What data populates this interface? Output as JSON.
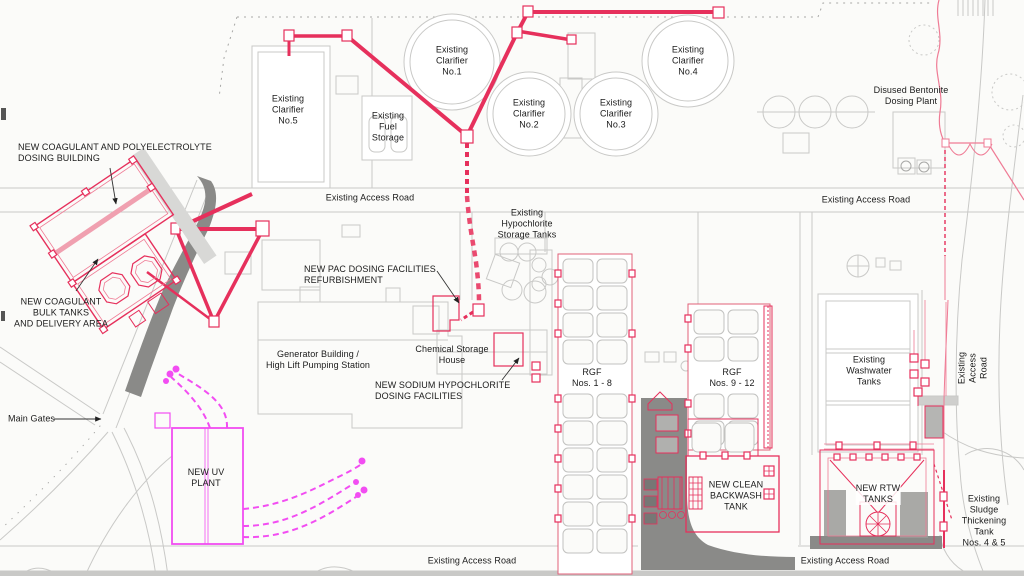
{
  "colors": {
    "bg": "#fbfbf9",
    "line": "#c9c9c7",
    "line-dark": "#a8a8a6",
    "pipe-red": "#e6305c",
    "pipe-dash": "#ea4a6f",
    "pink": "#ef7b95",
    "magenta": "#f24df2",
    "fill-dark": "#8a8a88",
    "fill-mid": "#9a9a98",
    "band": "#c9c9c7",
    "cell": "#c2c2c0",
    "rgf-edge": "#e06078",
    "text": "#1b1b1b"
  },
  "labels": {
    "new_coagulant_building": "NEW COAGULANT AND POLYELECTROLYTE\nDOSING BUILDING",
    "new_coagulant_tanks": "NEW COAGULANT\nBULK TANKS\nAND DELIVERY AREA",
    "main_gates": "Main Gates",
    "new_uv_plant": "NEW UV\nPLANT",
    "clarifier5": "Existing\nClarifier\nNo.5",
    "fuel_storage": "Existing\nFuel\nStorage",
    "clarifier1": "Existing\nClarifier\nNo.1",
    "clarifier2": "Existing\nClarifier\nNo.2",
    "clarifier3": "Existing\nClarifier\nNo.3",
    "clarifier4": "Existing\nClarifier\nNo.4",
    "disused_bentonite": "Disused Bentonite\nDosing Plant",
    "access_road_top": "Existing Access Road",
    "access_road_top_right": "Existing Access Road",
    "hypochlorite_tanks": "Existing\nHypochlorite\nStorage Tanks",
    "new_pac": "NEW PAC DOSING FACILITIES\nREFURBISHMENT",
    "chemical_storage_house": "Chemical Storage\nHouse",
    "generator_building": "Generator Building /\nHigh Lift Pumping Station",
    "new_sodium_hypochlorite": "NEW SODIUM HYPOCHLORITE\nDOSING FACILITIES",
    "rgf_1_8": "RGF\nNos. 1 - 8",
    "rgf_9_12": "RGF\nNos. 9 - 12",
    "washwater_tanks": "Existing\nWashwater\nTanks",
    "new_clean_backwash": "NEW CLEAN\nBACKWASH\nTANK",
    "new_rtw_tanks": "NEW RTW\nTANKS",
    "access_road_right": "Existing Access Road",
    "sludge_thickening": "Existing Sludge\nThickening Tank\nNos. 4 & 5",
    "access_road_bottom": "Existing Access Road",
    "access_road_bottom_right": "Existing Access Road"
  }
}
